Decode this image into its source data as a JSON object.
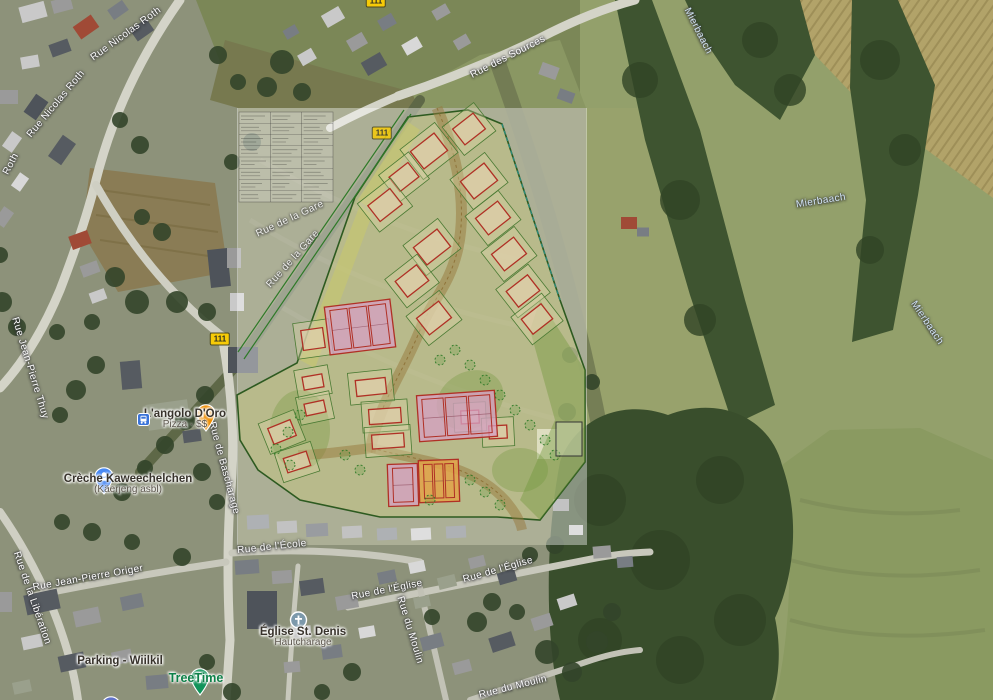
{
  "map": {
    "street_labels": [
      {
        "text": "Rue Nicolas Roth",
        "x": 126,
        "y": 34,
        "rot": -36,
        "kind": "street"
      },
      {
        "text": "Rue Nicolas Roth",
        "x": 56,
        "y": 104,
        "rot": -50,
        "kind": "street"
      },
      {
        "text": "Roth",
        "x": 11,
        "y": 164,
        "rot": -62,
        "kind": "street"
      },
      {
        "text": "Rue des Sources",
        "x": 508,
        "y": 57,
        "rot": -27,
        "kind": "street"
      },
      {
        "text": "Rue de la Gare",
        "x": 290,
        "y": 219,
        "rot": -25,
        "kind": "street",
        "opacity": 0.85
      },
      {
        "text": "Rue de la Gare",
        "x": 293,
        "y": 259,
        "rot": -48,
        "kind": "street",
        "opacity": 0.85
      },
      {
        "text": "Rue de Bascharage",
        "x": 224,
        "y": 468,
        "rot": 75,
        "kind": "street"
      },
      {
        "text": "Rue Jean-Pierre Thuy",
        "x": 30,
        "y": 368,
        "rot": 73,
        "kind": "street"
      },
      {
        "text": "Rue de la Libération",
        "x": 32,
        "y": 598,
        "rot": 71,
        "kind": "street"
      },
      {
        "text": "Rue Jean-Pierre Origer",
        "x": 88,
        "y": 578,
        "rot": -10,
        "kind": "street"
      },
      {
        "text": "Rue de l'École",
        "x": 272,
        "y": 547,
        "rot": -6,
        "kind": "street"
      },
      {
        "text": "Rue de l'Église",
        "x": 387,
        "y": 590,
        "rot": -11,
        "kind": "street"
      },
      {
        "text": "Rue de l'Église",
        "x": 498,
        "y": 570,
        "rot": -16,
        "kind": "street"
      },
      {
        "text": "Rue du Moulin",
        "x": 410,
        "y": 630,
        "rot": 73,
        "kind": "street"
      },
      {
        "text": "Rue du Moulin",
        "x": 513,
        "y": 687,
        "rot": -14,
        "kind": "street"
      },
      {
        "text": "Mierbaach",
        "x": 698,
        "y": 31,
        "rot": 63,
        "kind": "water"
      },
      {
        "text": "Mierbaach",
        "x": 821,
        "y": 201,
        "rot": -9,
        "kind": "water"
      },
      {
        "text": "Mierbaach",
        "x": 927,
        "y": 323,
        "rot": 56,
        "kind": "water"
      }
    ],
    "route_shields": [
      {
        "text": "111",
        "x": 220,
        "y": 339
      },
      {
        "text": "111",
        "x": 376,
        "y": 1
      },
      {
        "text": "111",
        "x": 382,
        "y": 133,
        "opacity": 0.85
      }
    ],
    "pois": [
      {
        "id": "langolo-doro",
        "type": "restaurant",
        "name": "L'angolo D'Oro",
        "sub": "Pizza · $$",
        "pin": {
          "x": 196,
          "y": 404
        },
        "label": {
          "x": 185,
          "y": 408
        },
        "pin_color": "#ef8e00"
      },
      {
        "id": "bus-stop",
        "type": "transit",
        "name": "",
        "pin": {
          "x": 137,
          "y": 413
        },
        "pin_color": "#3b74d9"
      },
      {
        "id": "creche",
        "type": "school",
        "name": "Crèche Kaweechelchen",
        "sub": "(Käerjeng asbl)",
        "pin": {
          "x": 94,
          "y": 467
        },
        "label": {
          "x": 128,
          "y": 473
        },
        "pin_color": "#4889f4"
      },
      {
        "id": "parking-wiilkil",
        "type": "parking",
        "name": "Parking - Wiilkil",
        "pin": {
          "x": 101,
          "y": 696
        },
        "label": {
          "x": 120,
          "y": 655
        },
        "pin_color": "#6173c9"
      },
      {
        "id": "treetime",
        "type": "tree",
        "name": "TreeTime",
        "green": true,
        "pin": {
          "x": 190,
          "y": 668
        },
        "label": {
          "x": 196,
          "y": 672
        },
        "pin_color": "#11945a"
      },
      {
        "id": "eglise-st-denis",
        "type": "church",
        "name": "Église St. Denis",
        "sub": "Hautcharage",
        "pin": {
          "x": 289,
          "y": 611
        },
        "label": {
          "x": 303,
          "y": 626
        },
        "pin_color": "#7d99ab"
      }
    ],
    "colors": {
      "shield_bg": "#f7cb07",
      "street_text": "#fdfdfd",
      "water_text": "#d2e4f5",
      "poi_text": "#38332c",
      "poi_green": "#0d8048"
    }
  },
  "site_plan": {
    "overlay_tint": "rgba(255,255,255,0.40)",
    "parcel_fill": "rgba(208,206,120,0.38)",
    "building_stroke": "#b03025",
    "upper_plots": [
      [
        429,
        151,
        30,
        22
      ],
      [
        469,
        129,
        26,
        20
      ],
      [
        404,
        177,
        24,
        18
      ],
      [
        385,
        205,
        28,
        20
      ],
      [
        479,
        181,
        30,
        22
      ],
      [
        493,
        218,
        28,
        21
      ],
      [
        432,
        247,
        30,
        22
      ],
      [
        412,
        281,
        27,
        20
      ],
      [
        509,
        254,
        28,
        21
      ],
      [
        523,
        291,
        27,
        20
      ],
      [
        434,
        318,
        28,
        21
      ],
      [
        537,
        319,
        25,
        19
      ]
    ],
    "lower_plots": [
      [
        313,
        339,
        22,
        20,
        -8
      ],
      [
        371,
        387,
        30,
        16,
        -6
      ],
      [
        385,
        416,
        32,
        15,
        -4
      ],
      [
        388,
        441,
        32,
        14,
        -4
      ],
      [
        313,
        382,
        20,
        13,
        -10
      ],
      [
        315,
        408,
        20,
        12,
        -12
      ],
      [
        282,
        432,
        24,
        17,
        -22
      ],
      [
        297,
        462,
        24,
        15,
        -18
      ],
      [
        470,
        417,
        18,
        13,
        -3
      ],
      [
        498,
        432,
        18,
        13,
        -3
      ]
    ],
    "blocks": [
      {
        "cx": 360,
        "cy": 327,
        "w": 66,
        "h": 48,
        "rot": -7,
        "kind": "pink",
        "units": 3
      },
      {
        "cx": 457,
        "cy": 416,
        "w": 78,
        "h": 46,
        "rot": -4,
        "kind": "pink",
        "units": 3
      },
      {
        "cx": 403,
        "cy": 485,
        "w": 30,
        "h": 42,
        "rot": -2,
        "kind": "pink",
        "units": 1
      },
      {
        "cx": 439,
        "cy": 481,
        "w": 40,
        "h": 42,
        "rot": -2,
        "kind": "orange",
        "units": 3
      }
    ],
    "trees": [
      [
        455,
        350
      ],
      [
        470,
        365
      ],
      [
        485,
        380
      ],
      [
        500,
        395
      ],
      [
        515,
        410
      ],
      [
        530,
        425
      ],
      [
        545,
        440
      ],
      [
        555,
        455
      ],
      [
        440,
        360
      ],
      [
        300,
        415
      ],
      [
        288,
        432
      ],
      [
        276,
        449
      ],
      [
        290,
        465
      ],
      [
        470,
        480
      ],
      [
        485,
        492
      ],
      [
        500,
        505
      ],
      [
        430,
        500
      ],
      [
        360,
        470
      ],
      [
        345,
        455
      ]
    ],
    "table": {
      "x": 239,
      "y": 112,
      "w": 94,
      "h": 90,
      "cols": 3,
      "rows": 8
    }
  },
  "decor": {
    "house_palette": [
      "#c9c9c9",
      "#9a9a9a",
      "#787d83",
      "#565b61",
      "#a04a36",
      "#d8d8d8",
      "#4e535a",
      "#9aa08c"
    ],
    "houses": [
      [
        33,
        12,
        26,
        16,
        -15,
        0
      ],
      [
        62,
        5,
        20,
        13,
        -15,
        1
      ],
      [
        86,
        27,
        22,
        15,
        -35,
        4
      ],
      [
        118,
        10,
        18,
        12,
        -35,
        2
      ],
      [
        142,
        30,
        20,
        14,
        -35,
        3
      ],
      [
        60,
        48,
        20,
        13,
        -20,
        3
      ],
      [
        30,
        62,
        18,
        12,
        -10,
        0
      ],
      [
        8,
        97,
        20,
        14,
        0,
        1
      ],
      [
        36,
        107,
        22,
        15,
        -55,
        6
      ],
      [
        12,
        142,
        18,
        12,
        -55,
        0
      ],
      [
        62,
        150,
        26,
        16,
        -55,
        3
      ],
      [
        20,
        182,
        16,
        11,
        -55,
        5
      ],
      [
        4,
        217,
        18,
        12,
        -55,
        1
      ],
      [
        80,
        240,
        20,
        14,
        -20,
        4
      ],
      [
        90,
        269,
        18,
        12,
        -20,
        1
      ],
      [
        98,
        296,
        16,
        11,
        -20,
        0
      ],
      [
        219,
        268,
        20,
        38,
        -6,
        6
      ],
      [
        131,
        375,
        20,
        28,
        -5,
        3
      ],
      [
        168,
        415,
        42,
        26,
        -8,
        7
      ],
      [
        192,
        436,
        18,
        12,
        -8,
        3
      ],
      [
        234,
        258,
        14,
        20,
        0,
        1
      ],
      [
        237,
        302,
        14,
        18,
        0,
        0
      ],
      [
        333,
        17,
        20,
        14,
        -30,
        0
      ],
      [
        357,
        42,
        18,
        13,
        -30,
        1
      ],
      [
        387,
        22,
        16,
        12,
        -30,
        2
      ],
      [
        412,
        46,
        18,
        12,
        -30,
        5
      ],
      [
        441,
        12,
        16,
        11,
        -30,
        1
      ],
      [
        374,
        64,
        22,
        15,
        -30,
        3
      ],
      [
        307,
        57,
        16,
        12,
        -30,
        0
      ],
      [
        291,
        32,
        14,
        10,
        -30,
        2
      ],
      [
        462,
        42,
        15,
        11,
        -30,
        1
      ],
      [
        549,
        71,
        18,
        13,
        20,
        1
      ],
      [
        566,
        96,
        16,
        11,
        20,
        2
      ],
      [
        629,
        223,
        16,
        12,
        0,
        4
      ],
      [
        643,
        232,
        12,
        9,
        0,
        2
      ],
      [
        547,
        444,
        20,
        30,
        0,
        5
      ],
      [
        561,
        505,
        16,
        12,
        0,
        1
      ],
      [
        576,
        530,
        14,
        10,
        0,
        0
      ],
      [
        258,
        522,
        22,
        14,
        -3,
        2
      ],
      [
        287,
        527,
        20,
        12,
        -3,
        1
      ],
      [
        317,
        530,
        22,
        13,
        -3,
        3
      ],
      [
        352,
        532,
        20,
        12,
        -3,
        1
      ],
      [
        387,
        534,
        20,
        12,
        -3,
        2
      ],
      [
        421,
        534,
        20,
        12,
        -3,
        0
      ],
      [
        456,
        532,
        20,
        12,
        -3,
        2
      ],
      [
        243,
        360,
        30,
        26,
        0,
        6
      ],
      [
        42,
        602,
        34,
        20,
        -12,
        3
      ],
      [
        87,
        617,
        26,
        16,
        -12,
        1
      ],
      [
        132,
        602,
        22,
        14,
        -12,
        2
      ],
      [
        32,
        642,
        20,
        13,
        -12,
        0
      ],
      [
        72,
        662,
        26,
        16,
        -12,
        3
      ],
      [
        122,
        657,
        20,
        13,
        -12,
        1
      ],
      [
        22,
        687,
        18,
        12,
        -12,
        7
      ],
      [
        157,
        682,
        22,
        14,
        -5,
        2
      ],
      [
        5,
        602,
        14,
        20,
        0,
        1
      ],
      [
        247,
        567,
        24,
        14,
        -4,
        2
      ],
      [
        282,
        577,
        20,
        13,
        -4,
        1
      ],
      [
        312,
        587,
        24,
        15,
        -8,
        3
      ],
      [
        347,
        602,
        22,
        14,
        -10,
        1
      ],
      [
        262,
        610,
        30,
        38,
        0,
        6
      ],
      [
        302,
        632,
        18,
        12,
        -5,
        0
      ],
      [
        332,
        652,
        20,
        13,
        -8,
        2
      ],
      [
        292,
        667,
        16,
        11,
        -5,
        1
      ],
      [
        367,
        632,
        16,
        11,
        -10,
        5
      ],
      [
        432,
        642,
        22,
        14,
        -15,
        2
      ],
      [
        462,
        667,
        18,
        12,
        -15,
        1
      ],
      [
        502,
        642,
        24,
        15,
        -18,
        3
      ],
      [
        542,
        622,
        20,
        13,
        -18,
        1
      ],
      [
        567,
        602,
        18,
        12,
        -18,
        0
      ],
      [
        422,
        602,
        16,
        11,
        -12,
        7
      ],
      [
        387,
        577,
        18,
        12,
        -12,
        2
      ],
      [
        417,
        567,
        16,
        11,
        -12,
        5
      ],
      [
        447,
        582,
        18,
        12,
        -14,
        7
      ],
      [
        477,
        562,
        16,
        11,
        -14,
        1
      ],
      [
        507,
        577,
        18,
        12,
        -16,
        3
      ],
      [
        602,
        552,
        18,
        12,
        -5,
        1
      ],
      [
        625,
        562,
        16,
        11,
        -5,
        2
      ]
    ],
    "trees": [
      [
        282,
        62,
        12
      ],
      [
        267,
        87,
        10
      ],
      [
        302,
        92,
        9
      ],
      [
        142,
        217,
        8
      ],
      [
        162,
        232,
        9
      ],
      [
        232,
        162,
        8
      ],
      [
        252,
        142,
        9
      ],
      [
        2,
        302,
        10
      ],
      [
        17,
        327,
        9
      ],
      [
        57,
        332,
        8
      ],
      [
        115,
        277,
        10
      ],
      [
        137,
        302,
        12
      ],
      [
        177,
        302,
        11
      ],
      [
        207,
        312,
        9
      ],
      [
        92,
        322,
        8
      ],
      [
        205,
        395,
        9
      ],
      [
        185,
        420,
        10
      ],
      [
        165,
        445,
        9
      ],
      [
        145,
        468,
        8
      ],
      [
        122,
        492,
        9
      ],
      [
        202,
        472,
        9
      ],
      [
        217,
        502,
        8
      ],
      [
        92,
        532,
        9
      ],
      [
        62,
        522,
        8
      ],
      [
        132,
        542,
        8
      ],
      [
        182,
        557,
        9
      ],
      [
        477,
        622,
        10
      ],
      [
        492,
        602,
        9
      ],
      [
        517,
        612,
        8
      ],
      [
        547,
        652,
        12
      ],
      [
        572,
        672,
        10
      ],
      [
        597,
        642,
        11
      ],
      [
        612,
        612,
        9
      ],
      [
        432,
        617,
        8
      ],
      [
        352,
        672,
        9
      ],
      [
        322,
        692,
        8
      ],
      [
        232,
        692,
        9
      ],
      [
        207,
        662,
        8
      ],
      [
        567,
        412,
        9
      ],
      [
        592,
        382,
        8
      ],
      [
        570,
        355,
        8
      ],
      [
        96,
        365,
        9
      ],
      [
        76,
        390,
        10
      ],
      [
        60,
        415,
        8
      ],
      [
        238,
        82,
        8
      ],
      [
        218,
        55,
        9
      ],
      [
        120,
        120,
        8
      ],
      [
        140,
        145,
        9
      ],
      [
        0,
        255,
        8
      ],
      [
        555,
        545,
        9
      ],
      [
        530,
        555,
        8
      ]
    ],
    "forest_blobs": [
      [
        640,
        80,
        18
      ],
      [
        680,
        200,
        20
      ],
      [
        700,
        320,
        16
      ],
      [
        600,
        500,
        26
      ],
      [
        660,
        560,
        30
      ],
      [
        720,
        480,
        24
      ],
      [
        740,
        620,
        26
      ],
      [
        880,
        60,
        20
      ],
      [
        905,
        150,
        16
      ],
      [
        760,
        40,
        18
      ],
      [
        790,
        90,
        16
      ],
      [
        870,
        250,
        14
      ],
      [
        600,
        640,
        22
      ],
      [
        680,
        660,
        24
      ]
    ]
  }
}
